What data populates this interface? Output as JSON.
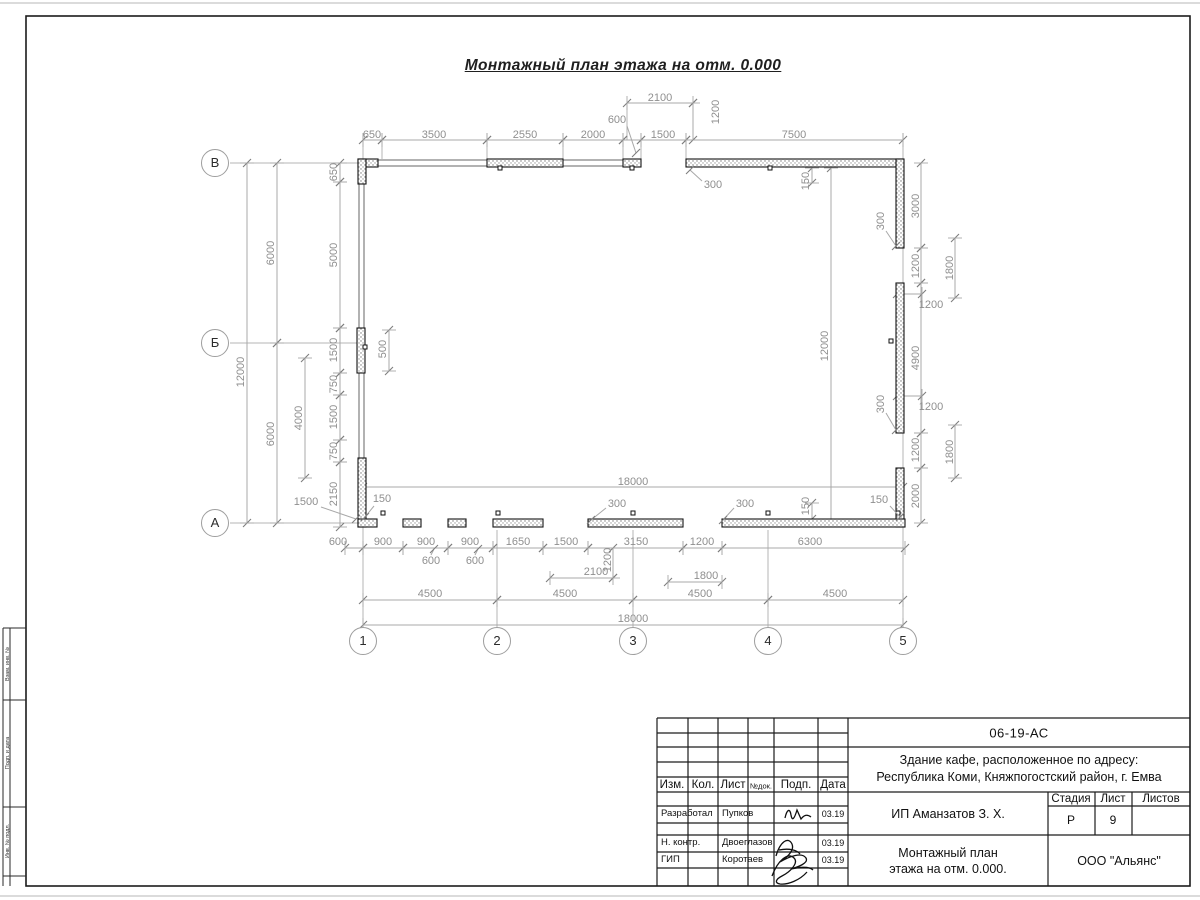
{
  "title": "Монтажный план этажа на отм. 0.000",
  "colors": {
    "dim_line": "#a8a8a8",
    "dim_text": "#8f8f8f",
    "tick": "#7d7d7d",
    "axis_line": "#b4b4b4",
    "wall_stroke": "#141414",
    "frame": "#1c1c1c",
    "page_edge": "#cfcfcf"
  },
  "plan": {
    "axes_left": [
      {
        "label": "В",
        "cx": 215,
        "cy": 163
      },
      {
        "label": "Б",
        "cx": 215,
        "cy": 343
      },
      {
        "label": "А",
        "cx": 215,
        "cy": 523
      }
    ],
    "axes_bottom": [
      {
        "label": "1",
        "cx": 363,
        "cy": 641
      },
      {
        "label": "2",
        "cx": 497,
        "cy": 641
      },
      {
        "label": "3",
        "cx": 633,
        "cy": 641
      },
      {
        "label": "4",
        "cx": 768,
        "cy": 641
      },
      {
        "label": "5",
        "cx": 903,
        "cy": 641
      }
    ],
    "axis_lines": [
      [
        230,
        163,
        377,
        163
      ],
      [
        230,
        343,
        357,
        343
      ],
      [
        230,
        523,
        363,
        523
      ],
      [
        363,
        133,
        363,
        627
      ],
      [
        903,
        133,
        903,
        627
      ],
      [
        497,
        530,
        497,
        627
      ],
      [
        633,
        530,
        633,
        627
      ],
      [
        768,
        530,
        768,
        627
      ],
      [
        382,
        142,
        382,
        159
      ],
      [
        487,
        142,
        487,
        159
      ],
      [
        563,
        142,
        563,
        159
      ],
      [
        623,
        142,
        623,
        159
      ],
      [
        641,
        142,
        641,
        159
      ],
      [
        686,
        142,
        686,
        159
      ],
      [
        627,
        105,
        627,
        140
      ],
      [
        693,
        105,
        693,
        140
      ]
    ],
    "walls": [
      [
        358,
        159,
        20,
        8
      ],
      [
        358,
        159,
        8,
        25
      ],
      [
        487,
        159,
        76,
        8
      ],
      [
        623,
        159,
        18,
        8
      ],
      [
        686,
        159,
        217,
        8
      ],
      [
        896,
        159,
        8,
        89
      ],
      [
        896,
        283,
        8,
        150
      ],
      [
        896,
        468,
        8,
        59
      ],
      [
        357,
        328,
        8,
        45
      ],
      [
        358,
        458,
        8,
        69
      ],
      [
        358,
        519,
        19,
        8
      ],
      [
        403,
        519,
        18,
        8
      ],
      [
        448,
        519,
        18,
        8
      ],
      [
        493,
        519,
        50,
        8
      ],
      [
        588,
        519,
        95,
        8
      ],
      [
        722,
        519,
        183,
        8
      ]
    ],
    "thin_walls": [
      [
        378,
        160,
        109,
        6
      ],
      [
        563,
        160,
        60,
        6
      ],
      [
        359,
        183,
        5,
        145
      ],
      [
        359,
        373,
        5,
        85
      ]
    ],
    "marks": [
      [
        500,
        168
      ],
      [
        632,
        168
      ],
      [
        770,
        168
      ],
      [
        891,
        341
      ],
      [
        365,
        347
      ],
      [
        383,
        513
      ],
      [
        498,
        513
      ],
      [
        633,
        513
      ],
      [
        768,
        513
      ],
      [
        898,
        513
      ]
    ],
    "dims": [
      [
        363,
        140,
        382,
        140,
        "650",
        372,
        135,
        0
      ],
      [
        382,
        140,
        487,
        140,
        "3500",
        434,
        135,
        0
      ],
      [
        487,
        140,
        563,
        140,
        "2550",
        525,
        135,
        0
      ],
      [
        563,
        140,
        623,
        140,
        "2000",
        593,
        135,
        0
      ],
      [
        623,
        140,
        641,
        140,
        "",
        632,
        135,
        0
      ],
      [
        641,
        140,
        686,
        140,
        "1500",
        663,
        135,
        0
      ],
      [
        686,
        140,
        903,
        140,
        "7500",
        794,
        135,
        0
      ],
      [
        627,
        103,
        693,
        103,
        "2100",
        660,
        98,
        0
      ],
      [
        693,
        103,
        693,
        140,
        "1200",
        716,
        112,
        1
      ],
      [
        921,
        163,
        921,
        248,
        "3000",
        916,
        206,
        1
      ],
      [
        921,
        248,
        921,
        283,
        "1200",
        916,
        266,
        1
      ],
      [
        921,
        283,
        921,
        433,
        "4900",
        916,
        358,
        1
      ],
      [
        921,
        433,
        921,
        468,
        "1200",
        916,
        450,
        1
      ],
      [
        921,
        468,
        921,
        523,
        "2000",
        916,
        496,
        1
      ],
      [
        955,
        238,
        955,
        298,
        "1800",
        950,
        268,
        1
      ],
      [
        955,
        425,
        955,
        478,
        "1800",
        950,
        452,
        1
      ],
      [
        897,
        294,
        922,
        294,
        "1200",
        931,
        305,
        0
      ],
      [
        897,
        396,
        922,
        396,
        "1200",
        931,
        407,
        0
      ],
      [
        831,
        168,
        831,
        523,
        "12000",
        825,
        346,
        1
      ],
      [
        363,
        487,
        903,
        487,
        "18000",
        633,
        482,
        0
      ],
      [
        812,
        168,
        812,
        183,
        "150",
        806,
        181,
        1
      ],
      [
        812,
        503,
        812,
        519,
        "150",
        806,
        506,
        1
      ],
      [
        247,
        163,
        247,
        523,
        "12000",
        241,
        372,
        1
      ],
      [
        277,
        163,
        277,
        343,
        "6000",
        271,
        253,
        1
      ],
      [
        277,
        343,
        277,
        523,
        "6000",
        271,
        434,
        1
      ],
      [
        340,
        163,
        340,
        182,
        "650",
        334,
        172,
        1
      ],
      [
        340,
        182,
        340,
        328,
        "5000",
        334,
        255,
        1
      ],
      [
        340,
        328,
        340,
        373,
        "1500",
        334,
        350,
        1
      ],
      [
        340,
        373,
        340,
        395,
        "750",
        334,
        384,
        1
      ],
      [
        340,
        395,
        340,
        440,
        "1500",
        334,
        417,
        1
      ],
      [
        340,
        440,
        340,
        462,
        "750",
        334,
        451,
        1
      ],
      [
        340,
        462,
        340,
        527,
        "2150",
        334,
        494,
        1
      ],
      [
        305,
        358,
        305,
        478,
        "4000",
        299,
        418,
        1
      ],
      [
        389,
        330,
        389,
        371,
        "500",
        383,
        349,
        1
      ],
      [
        345,
        548,
        363,
        548,
        "600",
        338,
        542,
        0
      ],
      [
        363,
        548,
        403,
        548,
        "900",
        383,
        542,
        0
      ],
      [
        403,
        548,
        448,
        548,
        "900",
        426,
        542,
        0
      ],
      [
        448,
        548,
        493,
        548,
        "900",
        470,
        542,
        0
      ],
      [
        493,
        548,
        543,
        548,
        "1650",
        518,
        542,
        0
      ],
      [
        543,
        548,
        588,
        548,
        "1500",
        566,
        542,
        0
      ],
      [
        588,
        548,
        683,
        548,
        "3150",
        636,
        542,
        0
      ],
      [
        683,
        548,
        722,
        548,
        "1200",
        702,
        542,
        0
      ],
      [
        722,
        548,
        905,
        548,
        "6300",
        810,
        542,
        0
      ],
      [
        613,
        548,
        613,
        578,
        "1200",
        608,
        560,
        1
      ],
      [
        550,
        578,
        613,
        578,
        "2100",
        596,
        572,
        0
      ],
      [
        668,
        582,
        722,
        582,
        "1800",
        706,
        576,
        0
      ],
      [
        363,
        600,
        497,
        600,
        "4500",
        430,
        594,
        0
      ],
      [
        497,
        600,
        633,
        600,
        "4500",
        565,
        594,
        0
      ],
      [
        633,
        600,
        768,
        600,
        "4500",
        700,
        594,
        0
      ],
      [
        768,
        600,
        903,
        600,
        "4500",
        835,
        594,
        0
      ],
      [
        363,
        625,
        903,
        625,
        "18000",
        633,
        619,
        0
      ]
    ],
    "leaders": [
      [
        "600",
        617,
        120,
        [
          [
            627,
            126
          ],
          [
            636,
            153
          ]
        ],
        0
      ],
      [
        "300",
        713,
        185,
        [
          [
            702,
            181
          ],
          [
            690,
            170
          ]
        ],
        0
      ],
      [
        "300",
        881,
        221,
        [
          [
            886,
            231
          ],
          [
            896,
            246
          ]
        ],
        1
      ],
      [
        "300",
        881,
        404,
        [
          [
            886,
            413
          ],
          [
            896,
            430
          ]
        ],
        1
      ],
      [
        "150",
        879,
        500,
        [
          [
            890,
            506
          ],
          [
            900,
            517
          ]
        ],
        0
      ],
      [
        "150",
        382,
        499,
        [
          [
            374,
            506
          ],
          [
            365,
            517
          ]
        ],
        0
      ],
      [
        "1500",
        306,
        502,
        [
          [
            321,
            507
          ],
          [
            356,
            519
          ]
        ],
        0
      ],
      [
        "600",
        431,
        561,
        [
          [
            431,
            555
          ],
          [
            434,
            549
          ]
        ],
        0
      ],
      [
        "600",
        475,
        561,
        [
          [
            475,
            555
          ],
          [
            478,
            549
          ]
        ],
        0
      ],
      [
        "300",
        617,
        504,
        [
          [
            606,
            508
          ],
          [
            591,
            520
          ]
        ],
        0
      ],
      [
        "300",
        745,
        504,
        [
          [
            734,
            508
          ],
          [
            723,
            520
          ]
        ],
        0
      ]
    ]
  },
  "title_block": {
    "doc_number": "06-19-АС",
    "object_line1": "Здание кафе, расположенное по адресу:",
    "object_line2": "Республика Коми, Княжпогостский район, г. Емва",
    "cols": {
      "izm": "Изм.",
      "kol": "Кол.",
      "list": "Лист",
      "ndok": "№док.",
      "podp": "Подп.",
      "data": "Дата"
    },
    "stage_label": "Стадия",
    "sheet_label": "Лист",
    "sheets_label": "Листов",
    "stage": "Р",
    "sheet": "9",
    "client": "ИП Аманзатов З. Х.",
    "sheet_title_line1": "Монтажный план",
    "sheet_title_line2": "этажа на отм. 0.000.",
    "company": "ООО \"Альянс\"",
    "rows": [
      {
        "role": "Разработал",
        "name": "Пупков",
        "date": "03.19"
      },
      {
        "role": "Н. контр.",
        "name": "Двоеглазов",
        "date": "03.19"
      },
      {
        "role": "ГИП",
        "name": "Коротаев",
        "date": "03.19"
      }
    ]
  },
  "margin": {
    "labels": [
      "Взам. инв. №",
      "Подп. и дата",
      "Инв. № подл."
    ]
  }
}
